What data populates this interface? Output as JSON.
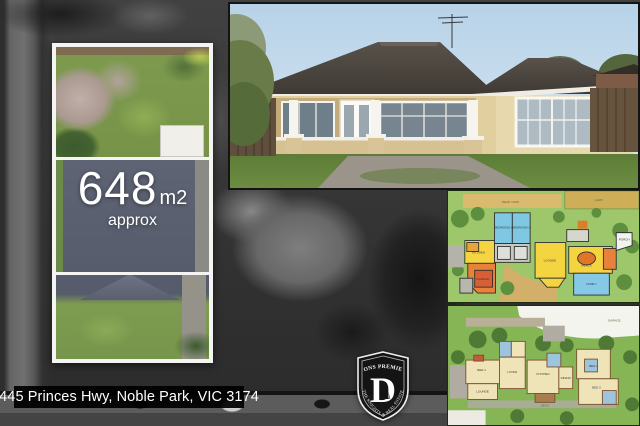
{
  "collage": {
    "land_area": {
      "value": "648",
      "unit": "m2",
      "qualifier": "approx"
    },
    "address": "445 Princes Hwy, Noble Park, VIC 3174",
    "logo": {
      "name_top": "DONS PREMIER",
      "monogram": "D",
      "knight_glyph": "♞",
      "tagline": "THE KNIGHTS OF REAL ESTATE"
    },
    "floorplan_top": {
      "labels": [
        "BEDROOM 2",
        "BEDROOM 3",
        "LOUNGE",
        "GARAGE",
        "KITCHEN",
        "MEALS",
        "FAMILY",
        "PORCH",
        "REAR YARD",
        "LAWN"
      ]
    },
    "floorplan_bottom": {
      "labels": [
        "BED 1",
        "LIVING",
        "KITCHEN",
        "DINING",
        "BED 2",
        "BED 3",
        "LOUNGE",
        "GARAGE",
        "DECK"
      ]
    },
    "colors": {
      "frame_white": "#f4f4f2",
      "address_bg": "#000000",
      "plan_green": "#8bc34a",
      "roof_slate": "#5c6170",
      "room_yellow": "#f5d442",
      "room_blue": "#7ec8e3",
      "room_orange": "#e8823a"
    }
  }
}
